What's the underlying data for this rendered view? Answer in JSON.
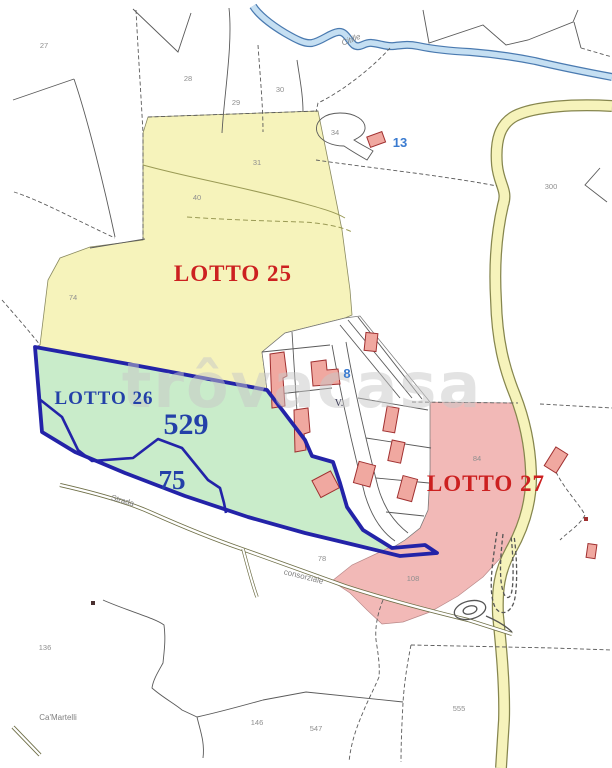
{
  "map": {
    "type": "cadastral-parcel-map",
    "watermark": "trôvacasa",
    "river_label": "Citille",
    "road_labels": {
      "strada": "Strada",
      "consorziale": "consorziale"
    },
    "locality_label": "Ca'Martelli",
    "lots": [
      {
        "id": "lotto-25",
        "label": "LOTTO 25",
        "fill": "#f6f3bb",
        "label_color": "#cc2020"
      },
      {
        "id": "lotto-26",
        "label": "LOTTO 26",
        "fill": "#c9ecca",
        "label_color": "#2340a8",
        "border_color": "#2323a8",
        "area_total": "529",
        "area_sub": "75"
      },
      {
        "id": "lotto-27",
        "label": "LOTTO 27",
        "fill": "#f2b9b7",
        "label_color": "#cc2020"
      }
    ],
    "building_refs": [
      {
        "v": "13"
      },
      {
        "v": "8"
      }
    ],
    "annotations": {
      "v_mark": "V."
    },
    "parcel_numbers": [
      {
        "v": "27"
      },
      {
        "v": "28"
      },
      {
        "v": "29"
      },
      {
        "v": "30"
      },
      {
        "v": "34"
      },
      {
        "v": "74"
      },
      {
        "v": "31"
      },
      {
        "v": "40"
      },
      {
        "v": "300"
      },
      {
        "v": "84"
      },
      {
        "v": "108"
      },
      {
        "v": "78"
      },
      {
        "v": "136"
      },
      {
        "v": "146"
      },
      {
        "v": "547"
      },
      {
        "v": "555"
      }
    ],
    "colors": {
      "zone_yellow": "#f6f3bb",
      "zone_green": "#c9ecca",
      "zone_pink": "#f2b9b7",
      "lot_border_blue": "#2323a8",
      "label_red": "#cc2020",
      "label_blue": "#2340a8",
      "ref_blue": "#3a7bd0",
      "river_blue": "#c5dff2",
      "road_yellow": "#f6f3bb"
    }
  }
}
